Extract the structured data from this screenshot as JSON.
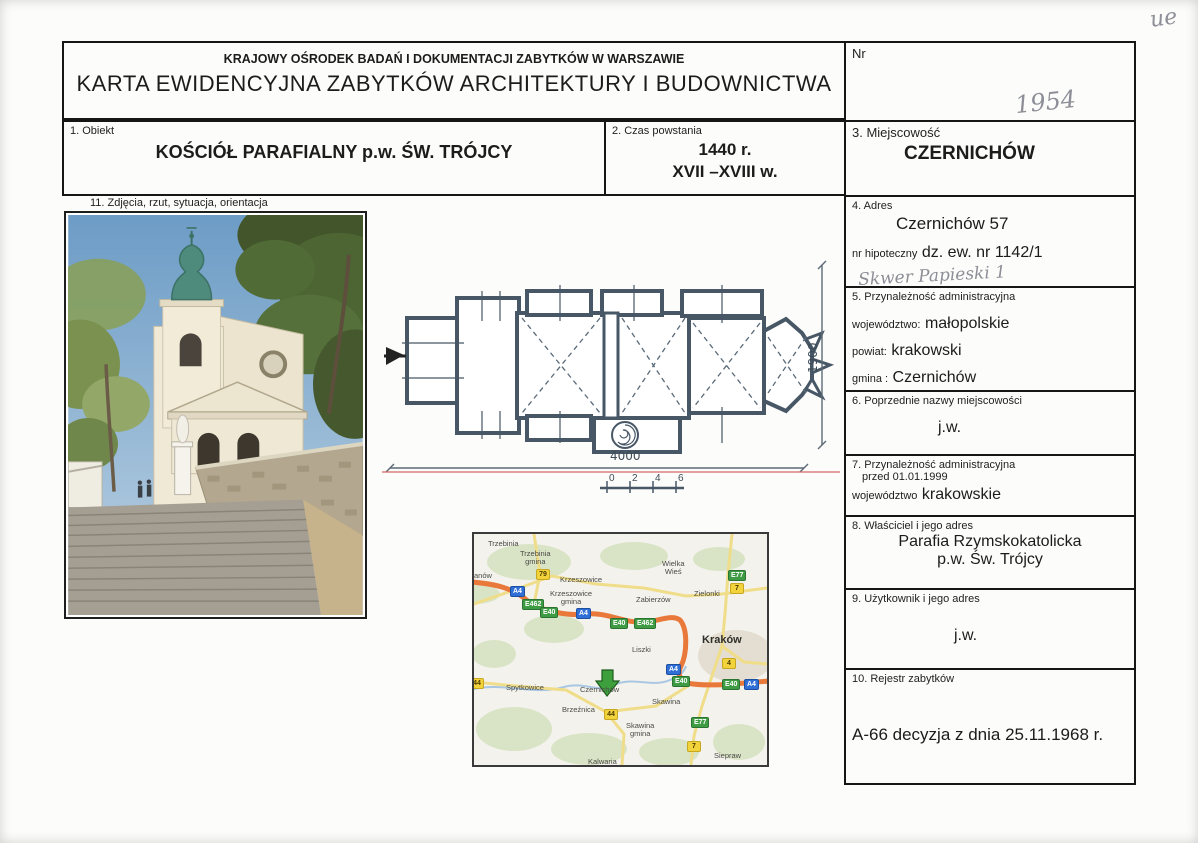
{
  "page": {
    "corner_mark": "ue"
  },
  "header": {
    "org": "KRAJOWY OŚRODEK BADAŃ I DOKUMENTACJI ZABYTKÓW W WARSZAWIE",
    "title": "KARTA EWIDENCYJNA ZABYTKÓW ARCHITEKTURY I BUDOWNICTWA",
    "nr_label": "Nr",
    "nr_handwritten": "1954"
  },
  "fields": {
    "obiekt": {
      "label": "1. Obiekt",
      "value": "KOŚCIÓŁ PARAFIALNY p.w. ŚW. TRÓJCY"
    },
    "czas": {
      "label": "2. Czas powstania",
      "line1": "1440 r.",
      "line2": "XVII –XVIII w."
    },
    "miejscowosc": {
      "label": "3. Miejscowość",
      "value": "CZERNICHÓW"
    },
    "adres": {
      "label": "4. Adres",
      "value": "Czernichów 57",
      "hipoteczny_label": "nr hipoteczny",
      "hipoteczny_value": "dz. ew. nr  1142/1",
      "handwritten": "Skwer Papieski 1"
    },
    "przynaleznosc": {
      "label": "5. Przynależność administracyjna",
      "wojewodztwo_label": "województwo:",
      "wojewodztwo": "małopolskie",
      "powiat_label": "powiat:",
      "powiat": "krakowski",
      "gmina_label": "gmina :",
      "gmina": "Czernichów"
    },
    "poprzednie": {
      "label": "6. Poprzednie nazwy miejscowości",
      "value": "j.w."
    },
    "przed1999": {
      "label_line1": "7. Przynależność administracyjna",
      "label_line2": "przed 01.01.1999",
      "wojewodztwo_label": "województwo",
      "value": "krakowskie"
    },
    "wlasciciel": {
      "label": "8. Właściciel i jego adres",
      "line1": "Parafia Rzymskokatolicka",
      "line2": "p.w. Św. Trójcy"
    },
    "uzytkownik": {
      "label": "9. Użytkownik i jego adres",
      "value": "j.w."
    },
    "rejestr": {
      "label": "10. Rejestr zabytków",
      "value": "A-66 decyzja z dnia  25.11.1968 r."
    },
    "zdjecia": {
      "label": "11.   Zdjęcia, rzut, sytuacja, orientacja"
    }
  },
  "plan": {
    "dim_width": "4000",
    "dim_height": "1900",
    "scale_ticks": [
      "0",
      "2",
      "4",
      "6"
    ]
  },
  "map": {
    "labels": [
      {
        "text": "Trzebinia"
      },
      {
        "text": "Trzebinia\ngmina"
      },
      {
        "text": "anów"
      },
      {
        "text": "Krzeszowice"
      },
      {
        "text": "Krzeszowice\ngmina"
      },
      {
        "text": "Wielka\nWieś"
      },
      {
        "text": "Zielonki"
      },
      {
        "text": "Zabierzów"
      },
      {
        "text": "Kraków"
      },
      {
        "text": "Liszki"
      },
      {
        "text": "Spytkowice"
      },
      {
        "text": "Czernichów"
      },
      {
        "text": "Brzeźnica"
      },
      {
        "text": "Skawina"
      },
      {
        "text": "Skawina\ngmina"
      },
      {
        "text": "Siepraw"
      },
      {
        "text": "Kalwaria"
      }
    ],
    "shields": [
      {
        "text": "79",
        "type": "yellow"
      },
      {
        "text": "A4",
        "type": "blue"
      },
      {
        "text": "E462",
        "type": "green"
      },
      {
        "text": "E40",
        "type": "green"
      },
      {
        "text": "A4",
        "type": "blue"
      },
      {
        "text": "E40",
        "type": "green"
      },
      {
        "text": "E462",
        "type": "green"
      },
      {
        "text": "E77",
        "type": "green"
      },
      {
        "text": "7",
        "type": "yellow"
      },
      {
        "text": "4",
        "type": "yellow"
      },
      {
        "text": "A4",
        "type": "blue"
      },
      {
        "text": "E40",
        "type": "green"
      },
      {
        "text": "E40",
        "type": "green"
      },
      {
        "text": "A4",
        "type": "blue"
      },
      {
        "text": "44",
        "type": "yellow"
      },
      {
        "text": "E77",
        "type": "green"
      },
      {
        "text": "7",
        "type": "yellow"
      },
      {
        "text": "44",
        "type": "yellow"
      }
    ]
  }
}
